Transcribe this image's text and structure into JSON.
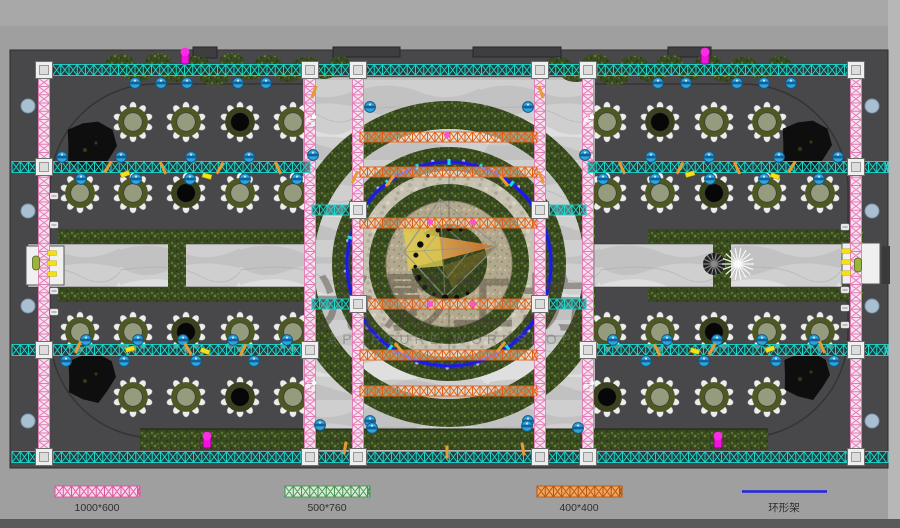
{
  "watermark": {
    "cn": "光影工坊",
    "en": "APERTURE WORKSHOP"
  },
  "legend": {
    "items": [
      {
        "label": "1000*600",
        "swatch": "truss",
        "color": "#d9559d",
        "bg": "#f7d9ea",
        "cx": 97,
        "x1": 55,
        "x2": 140
      },
      {
        "label": "500*760",
        "swatch": "truss",
        "color": "#44934f",
        "bg": "#d9ead9",
        "cx": 327,
        "x1": 285,
        "x2": 370
      },
      {
        "label": "400*400",
        "swatch": "truss",
        "color": "#b85510",
        "bg": "#eda75f",
        "cx": 579,
        "x1": 537,
        "x2": 622
      },
      {
        "label": "环形架",
        "swatch": "line",
        "color": "#2323e0",
        "bg": "none",
        "cx": 784,
        "x1": 742,
        "x2": 827
      }
    ]
  },
  "colors": {
    "floor": "#48484a",
    "outer": "#9f9f9f",
    "cyan_truss": "#1bd8ce",
    "pink_truss": "#e27bb4",
    "orange_truss": "#df5f14",
    "ring_truss": "#1a1aee",
    "blue_light": "#2ba6e2",
    "magenta_light": "#f013dc"
  },
  "plan": {
    "trusses": {
      "h_cyan": [
        {
          "x1": 36,
          "x2": 864,
          "y": 70
        },
        {
          "x1": 12,
          "x2": 310,
          "y": 167
        },
        {
          "x1": 588,
          "x2": 888,
          "y": 167
        },
        {
          "x1": 12,
          "x2": 310,
          "y": 350
        },
        {
          "x1": 588,
          "x2": 888,
          "y": 350
        },
        {
          "x1": 12,
          "x2": 888,
          "y": 457
        }
      ],
      "stubs_cyan": [
        {
          "x1": 312,
          "x2": 356,
          "y": 210
        },
        {
          "x1": 542,
          "x2": 586,
          "y": 210
        },
        {
          "x1": 312,
          "x2": 356,
          "y": 304
        },
        {
          "x1": 542,
          "x2": 586,
          "y": 304
        }
      ],
      "v_pink": [
        {
          "x": 44,
          "y1": 70,
          "y2": 457
        },
        {
          "x": 310,
          "y1": 70,
          "y2": 457
        },
        {
          "x": 358,
          "y1": 70,
          "y2": 457
        },
        {
          "x": 540,
          "y1": 70,
          "y2": 457
        },
        {
          "x": 588,
          "y1": 70,
          "y2": 457
        },
        {
          "x": 856,
          "y1": 70,
          "y2": 457
        }
      ],
      "orange_center": [
        {
          "x1": 360,
          "x2": 537,
          "y": 137
        },
        {
          "x1": 360,
          "x2": 537,
          "y": 172
        },
        {
          "x1": 360,
          "x2": 537,
          "y": 223
        },
        {
          "x1": 360,
          "x2": 537,
          "y": 304
        },
        {
          "x1": 360,
          "x2": 537,
          "y": 355
        },
        {
          "x1": 360,
          "x2": 537,
          "y": 391
        }
      ],
      "ring": {
        "cx": 449,
        "cy": 264,
        "r": 102
      }
    },
    "junctions": [
      [
        44,
        70
      ],
      [
        310,
        70
      ],
      [
        358,
        70
      ],
      [
        540,
        70
      ],
      [
        588,
        70
      ],
      [
        856,
        70
      ],
      [
        44,
        167
      ],
      [
        856,
        167
      ],
      [
        44,
        350
      ],
      [
        310,
        350
      ],
      [
        588,
        350
      ],
      [
        856,
        350
      ],
      [
        44,
        457
      ],
      [
        310,
        457
      ],
      [
        358,
        457
      ],
      [
        540,
        457
      ],
      [
        588,
        457
      ],
      [
        856,
        457
      ],
      [
        358,
        210
      ],
      [
        540,
        210
      ],
      [
        358,
        304
      ],
      [
        540,
        304
      ]
    ],
    "tables": [
      [
        133,
        122,
        0
      ],
      [
        186,
        122,
        0
      ],
      [
        240,
        122,
        1
      ],
      [
        293,
        122,
        0
      ],
      [
        80,
        193,
        0
      ],
      [
        133,
        193,
        0
      ],
      [
        186,
        193,
        1
      ],
      [
        240,
        193,
        0
      ],
      [
        293,
        193,
        0
      ],
      [
        80,
        332,
        0
      ],
      [
        133,
        332,
        0
      ],
      [
        186,
        332,
        1
      ],
      [
        240,
        332,
        0
      ],
      [
        293,
        332,
        0
      ],
      [
        133,
        397,
        0
      ],
      [
        186,
        397,
        0
      ],
      [
        240,
        397,
        1
      ],
      [
        293,
        397,
        0
      ],
      [
        607,
        122,
        0
      ],
      [
        660,
        122,
        1
      ],
      [
        714,
        122,
        0
      ],
      [
        767,
        122,
        0
      ],
      [
        607,
        193,
        0
      ],
      [
        660,
        193,
        0
      ],
      [
        714,
        193,
        1
      ],
      [
        767,
        193,
        0
      ],
      [
        820,
        193,
        0
      ],
      [
        607,
        332,
        0
      ],
      [
        660,
        332,
        0
      ],
      [
        714,
        332,
        1
      ],
      [
        767,
        332,
        0
      ],
      [
        820,
        332,
        0
      ],
      [
        607,
        397,
        1
      ],
      [
        660,
        397,
        0
      ],
      [
        714,
        397,
        0
      ],
      [
        767,
        397,
        0
      ]
    ],
    "trees": [
      [
        90,
        146,
        27
      ],
      [
        90,
        377,
        26
      ],
      [
        805,
        145,
        27
      ],
      [
        805,
        375,
        25
      ]
    ],
    "stage_rects": [
      [
        193,
        47,
        24,
        11
      ],
      [
        333,
        47,
        67,
        10
      ],
      [
        473,
        47,
        88,
        10
      ],
      [
        668,
        47,
        43,
        10
      ]
    ],
    "lights": {
      "blue": [
        [
          135,
          83
        ],
        [
          161,
          83
        ],
        [
          187,
          83
        ],
        [
          238,
          83
        ],
        [
          266,
          83
        ],
        [
          658,
          83
        ],
        [
          686,
          83
        ],
        [
          737,
          83
        ],
        [
          764,
          83
        ],
        [
          791,
          83
        ],
        [
          62,
          157
        ],
        [
          121,
          157
        ],
        [
          191,
          157
        ],
        [
          249,
          157
        ],
        [
          651,
          157
        ],
        [
          709,
          157
        ],
        [
          779,
          157
        ],
        [
          838,
          157
        ],
        [
          81,
          179
        ],
        [
          136,
          179
        ],
        [
          190,
          179
        ],
        [
          245,
          179
        ],
        [
          297,
          179
        ],
        [
          603,
          179
        ],
        [
          655,
          179
        ],
        [
          710,
          179
        ],
        [
          764,
          179
        ],
        [
          819,
          179
        ],
        [
          86,
          340
        ],
        [
          138,
          340
        ],
        [
          183,
          340
        ],
        [
          233,
          340
        ],
        [
          287,
          340
        ],
        [
          613,
          340
        ],
        [
          667,
          340
        ],
        [
          717,
          340
        ],
        [
          762,
          340
        ],
        [
          814,
          340
        ],
        [
          66,
          361
        ],
        [
          124,
          361
        ],
        [
          196,
          361
        ],
        [
          254,
          361
        ],
        [
          646,
          361
        ],
        [
          704,
          361
        ],
        [
          776,
          361
        ],
        [
          834,
          361
        ],
        [
          370,
          107
        ],
        [
          528,
          107
        ],
        [
          313,
          155
        ],
        [
          585,
          155
        ],
        [
          370,
          421
        ],
        [
          528,
          421
        ],
        [
          320,
          425
        ],
        [
          372,
          428
        ],
        [
          527,
          426
        ],
        [
          578,
          428
        ]
      ],
      "magenta": [
        [
          185,
          56
        ],
        [
          705,
          56
        ],
        [
          207,
          440
        ],
        [
          718,
          440
        ]
      ],
      "edge_dots": [
        [
          28,
          106
        ],
        [
          28,
          211
        ],
        [
          28,
          306
        ],
        [
          28,
          421
        ],
        [
          872,
          106
        ],
        [
          872,
          211
        ],
        [
          872,
          306
        ],
        [
          872,
          421
        ]
      ]
    },
    "marks": {
      "yellow": [
        [
          125,
          174,
          -20
        ],
        [
          207,
          176,
          15
        ],
        [
          130,
          349,
          -15
        ],
        [
          205,
          351,
          20
        ],
        [
          690,
          174,
          -15
        ],
        [
          775,
          176,
          20
        ],
        [
          770,
          349,
          -20
        ],
        [
          695,
          351,
          15
        ],
        [
          52,
          253,
          0
        ],
        [
          52,
          263,
          0
        ],
        [
          52,
          274,
          0
        ],
        [
          846,
          251,
          0
        ],
        [
          846,
          262,
          0
        ],
        [
          846,
          273,
          0
        ]
      ],
      "amber": [
        [
          108,
          167,
          30
        ],
        [
          163,
          168,
          -25
        ],
        [
          220,
          168,
          30
        ],
        [
          278,
          168,
          -25
        ],
        [
          792,
          167,
          30
        ],
        [
          737,
          168,
          -25
        ],
        [
          680,
          168,
          30
        ],
        [
          622,
          168,
          -25
        ],
        [
          78,
          347,
          25
        ],
        [
          188,
          349,
          -30
        ],
        [
          243,
          350,
          25
        ],
        [
          822,
          347,
          -25
        ],
        [
          712,
          349,
          30
        ],
        [
          657,
          350,
          -25
        ],
        [
          314,
          92,
          20
        ],
        [
          541,
          92,
          -20
        ],
        [
          355,
          177,
          25
        ],
        [
          541,
          177,
          -25
        ],
        [
          390,
          181,
          40
        ],
        [
          504,
          181,
          -40
        ],
        [
          399,
          348,
          -40
        ],
        [
          501,
          347,
          40
        ],
        [
          345,
          448,
          10
        ],
        [
          447,
          452,
          0
        ],
        [
          523,
          449,
          -10
        ]
      ],
      "flowers": [
        [
          311,
          120
        ],
        [
          589,
          120
        ],
        [
          311,
          386
        ],
        [
          589,
          386
        ]
      ],
      "chair_icons": [
        [
          54,
          196
        ],
        [
          54,
          225
        ],
        [
          54,
          291
        ],
        [
          54,
          312
        ],
        [
          845,
          227
        ],
        [
          845,
          290
        ],
        [
          845,
          308
        ],
        [
          845,
          325
        ]
      ],
      "ring_pink_dots": [
        [
          430,
          222
        ],
        [
          473,
          222
        ],
        [
          430,
          304
        ],
        [
          473,
          304
        ],
        [
          447,
          135
        ]
      ],
      "persons": [
        [
          36,
          263
        ],
        [
          858,
          265
        ]
      ]
    }
  }
}
